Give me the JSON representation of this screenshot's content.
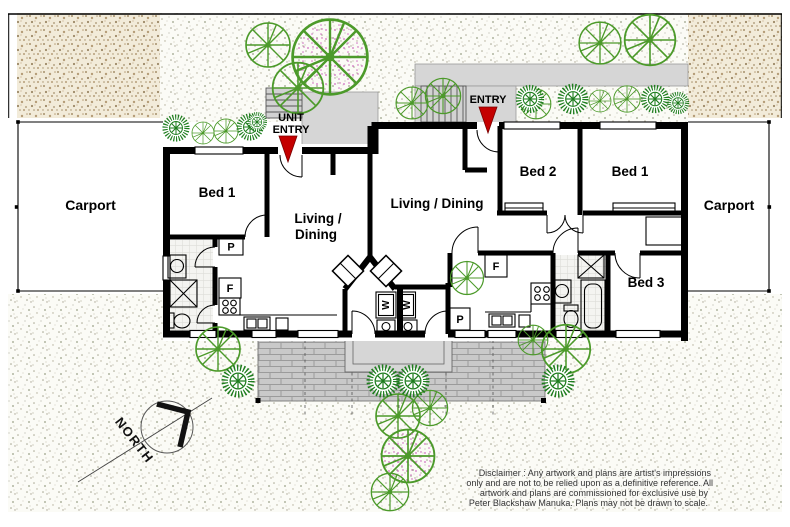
{
  "labels": {
    "carport_left": "Carport",
    "carport_right": "Carport",
    "bed1_left": "Bed 1",
    "living_dining_left_line1": "Living /",
    "living_dining_left_line2": "Dining",
    "living_dining_right": "Living / Dining",
    "bed2": "Bed 2",
    "bed1_right": "Bed 1",
    "bed3": "Bed 3",
    "unit_entry_line1": "UNIT",
    "unit_entry_line2": "ENTRY",
    "entry": "ENTRY",
    "north": "NORTH",
    "pantry_left": "P",
    "fridge_left": "F",
    "fridge_right": "F",
    "pantry_right": "P",
    "washer_left": "W",
    "washer_right": "W"
  },
  "disclaimer": {
    "line1": "Disclaimer : Any artwork and plans are artist's impressions",
    "line2": "only and are not to be relied upon as a definitive reference. All",
    "line3": "artwork and plans are commissioned for exclusive use by",
    "line4": "Peter Blackshaw Manuka. Plans may not be drawn to scale."
  },
  "colors": {
    "wall": "#000000",
    "tree_green": "#4c9a2a",
    "shrub_green": "#1e7d1e",
    "arrow_red": "#c40000",
    "driveway_beige": "#f2ebd9",
    "deck_gray": "#c9c9c9",
    "path_gray": "#d6d6d6"
  }
}
